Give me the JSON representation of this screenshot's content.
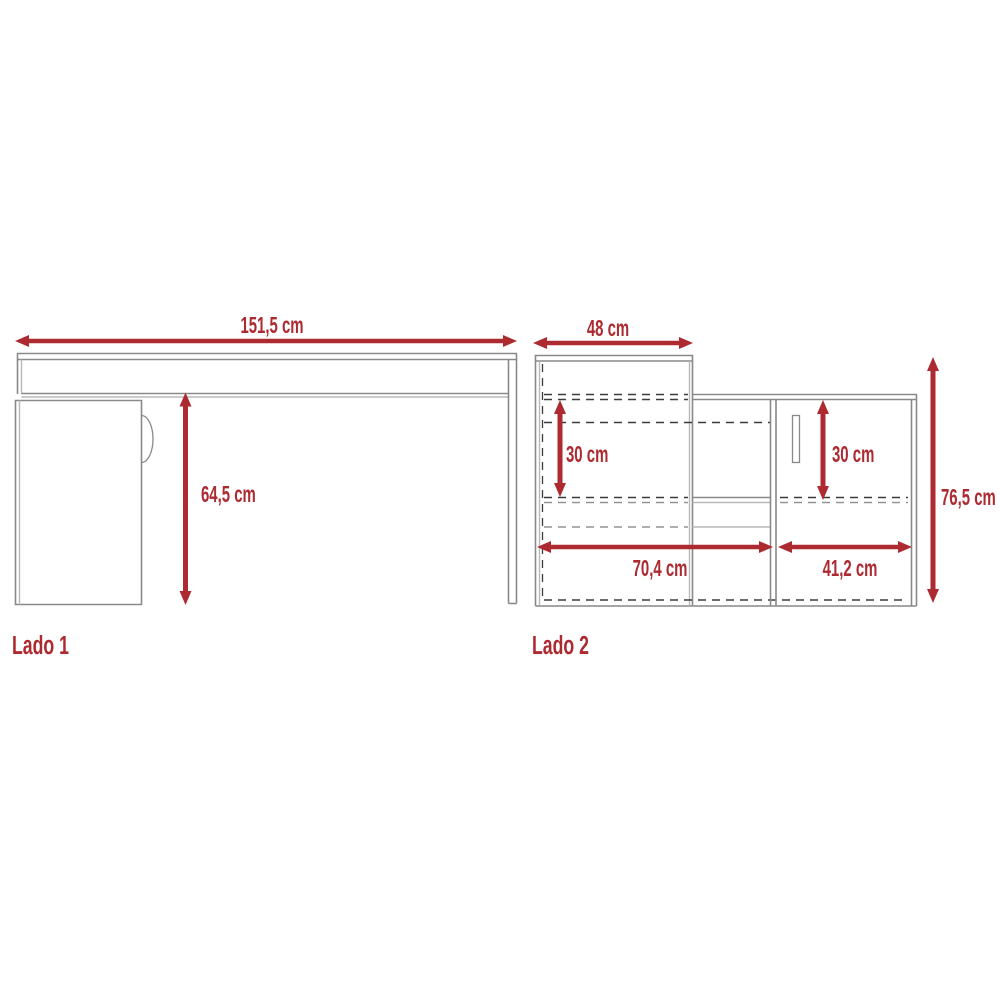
{
  "diagram": {
    "type": "furniture-dimension-drawing",
    "accent_red": "#ac2a30",
    "line_gray": "#898989",
    "dash_dark": "#3c3c3c",
    "unit": "cm"
  },
  "side1": {
    "label": "Lado 1",
    "width_dim": "151,5 cm",
    "height_dim": "64,5 cm"
  },
  "side2": {
    "label": "Lado 2",
    "top_dim": "48 cm",
    "left_shelf_dim": "30 cm",
    "door_dim": "30 cm",
    "bottom_left_dim": "70,4 cm",
    "bottom_right_dim": "41,2 cm",
    "height_dim": "76,5 cm"
  }
}
